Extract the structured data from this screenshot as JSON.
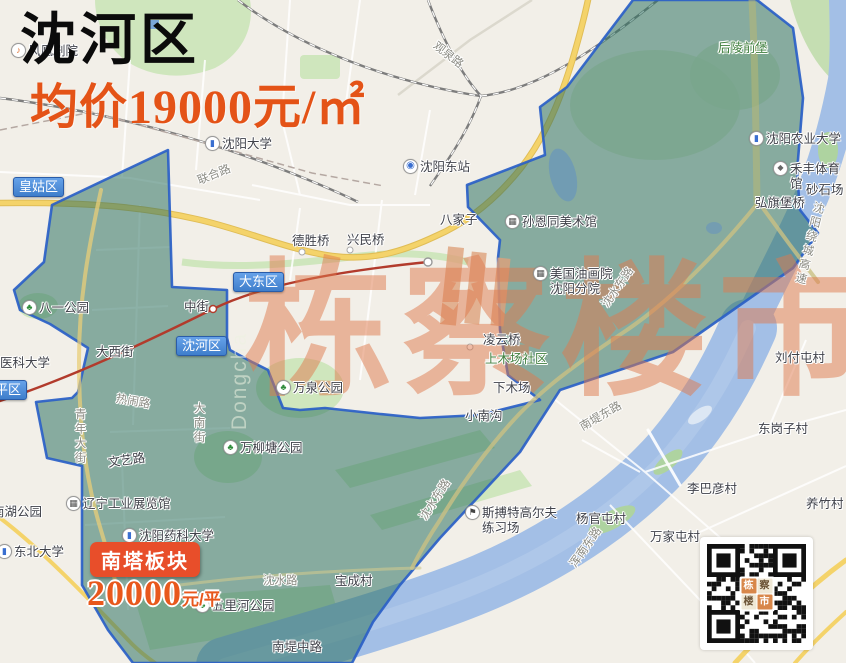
{
  "header": {
    "district": "沈河区",
    "price_line": "均价19000元/㎡",
    "partial_venue": "风凰剧院"
  },
  "badge": {
    "title": "南塔板块",
    "price": "20000",
    "unit": "元/平"
  },
  "watermark": {
    "main": "栋察楼市",
    "latin": "Dongcha"
  },
  "district_labels": [
    {
      "t": "皇姑区",
      "x": 13,
      "y": 177
    },
    {
      "t": "大东区",
      "x": 233,
      "y": 272
    },
    {
      "t": "沈河区",
      "x": 176,
      "y": 336
    },
    {
      "t": "和平区",
      "x": -24,
      "y": 380
    }
  ],
  "labels": [
    {
      "t": "沈阳大学",
      "x": 222,
      "y": 137,
      "icon": "bus"
    },
    {
      "t": "沈阳东站",
      "x": 420,
      "y": 160,
      "icon": "rail"
    },
    {
      "t": "观泉路",
      "x": 438,
      "y": 40,
      "cls": "road",
      "rot": 38
    },
    {
      "t": "联合路",
      "x": 196,
      "y": 176,
      "cls": "road",
      "rot": -22
    },
    {
      "t": "八家子",
      "x": 440,
      "y": 213
    },
    {
      "t": "德胜桥",
      "x": 292,
      "y": 234
    },
    {
      "t": "兴民桥",
      "x": 347,
      "y": 233
    },
    {
      "t": "孙恩同美术馆",
      "x": 522,
      "y": 215,
      "icon": "museum"
    },
    {
      "t": "美国油画院\n沈阳分院",
      "x": 550,
      "y": 267,
      "icon": "museum"
    },
    {
      "t": "后陵前堡",
      "x": 718,
      "y": 41,
      "cls": "green"
    },
    {
      "t": "沈阳农业大学",
      "x": 766,
      "y": 132,
      "icon": "bus"
    },
    {
      "t": "禾丰体育馆",
      "x": 790,
      "y": 162,
      "icon": "stadium"
    },
    {
      "t": "砂石场",
      "x": 806,
      "y": 183
    },
    {
      "t": "弘旗堡桥",
      "x": 755,
      "y": 196
    },
    {
      "t": "沈阳绕城高速",
      "x": 812,
      "y": 200,
      "cls": "road",
      "vert": true,
      "rot": 14
    },
    {
      "t": "中街",
      "x": 184,
      "y": 300
    },
    {
      "t": "大西街",
      "x": 96,
      "y": 345
    },
    {
      "t": "八一公园",
      "x": 39,
      "y": 301,
      "icon": "park"
    },
    {
      "t": "医科大学",
      "x": 0,
      "y": 356
    },
    {
      "t": "凌云桥",
      "x": 483,
      "y": 333
    },
    {
      "t": "上木场社区",
      "x": 485,
      "y": 352,
      "cls": "green"
    },
    {
      "t": "下木场",
      "x": 493,
      "y": 381
    },
    {
      "t": "小南沟",
      "x": 465,
      "y": 409
    },
    {
      "t": "沈水东路",
      "x": 600,
      "y": 303,
      "cls": "road",
      "rot": -55
    },
    {
      "t": "刘付屯村",
      "x": 775,
      "y": 351
    },
    {
      "t": "万泉公园",
      "x": 293,
      "y": 381,
      "icon": "park"
    },
    {
      "t": "万柳塘公园",
      "x": 240,
      "y": 441,
      "icon": "park"
    },
    {
      "t": "热闹路",
      "x": 117,
      "y": 393,
      "cls": "road",
      "rot": 10
    },
    {
      "t": "青年大街",
      "x": 72,
      "y": 408,
      "cls": "road",
      "vert": true
    },
    {
      "t": "大南街",
      "x": 191,
      "y": 402,
      "cls": "road",
      "vert": true
    },
    {
      "t": "文艺路",
      "x": 107,
      "y": 456,
      "rot": -8
    },
    {
      "t": "辽宁工业展览馆",
      "x": 83,
      "y": 497,
      "icon": "museum"
    },
    {
      "t": "南湖公园",
      "x": -8,
      "y": 505
    },
    {
      "t": "沈阳药科大学",
      "x": 139,
      "y": 529,
      "icon": "bus"
    },
    {
      "t": "东北大学",
      "x": 14,
      "y": 545,
      "icon": "bus"
    },
    {
      "t": "五里河公园",
      "x": 212,
      "y": 599,
      "icon": "park"
    },
    {
      "t": "沈水路",
      "x": 263,
      "y": 575,
      "cls": "road"
    },
    {
      "t": "宝成村",
      "x": 335,
      "y": 574
    },
    {
      "t": "南堤中路",
      "x": 272,
      "y": 640
    },
    {
      "t": "沈水东路",
      "x": 418,
      "y": 516,
      "cls": "road",
      "rot": -57
    },
    {
      "t": "斯搏特高尔夫\n练习场",
      "x": 482,
      "y": 506,
      "icon": "golf"
    },
    {
      "t": "南堤东路",
      "x": 578,
      "y": 423,
      "cls": "road",
      "rot": -30
    },
    {
      "t": "浑南东路",
      "x": 568,
      "y": 563,
      "cls": "road",
      "rot": -55
    },
    {
      "t": "杨官屯村",
      "x": 576,
      "y": 512
    },
    {
      "t": "万家屯村",
      "x": 650,
      "y": 530
    },
    {
      "t": "李巴彦村",
      "x": 687,
      "y": 482
    },
    {
      "t": "东岗子村",
      "x": 758,
      "y": 422
    },
    {
      "t": "养竹村",
      "x": 806,
      "y": 497
    },
    {
      "t": "风凰剧院",
      "x": 28,
      "y": 44,
      "icon": "music"
    }
  ],
  "icon_glyphs": {
    "park": "♣",
    "bus": "▮",
    "rail": "◉",
    "museum": "▦",
    "golf": "⚑",
    "stadium": "◆",
    "music": "♪"
  },
  "qr": {
    "logo_tiles": [
      "栋",
      "察",
      "楼",
      "市"
    ]
  },
  "colors": {
    "accent_orange": "#e45317",
    "badge_red": "#e84e2a",
    "overlay_teal": "#2f7262",
    "overlay_border_blue": "#2a5fc7",
    "river_blue": "#a3bfe6",
    "road_yellow": "#f4d36a"
  }
}
